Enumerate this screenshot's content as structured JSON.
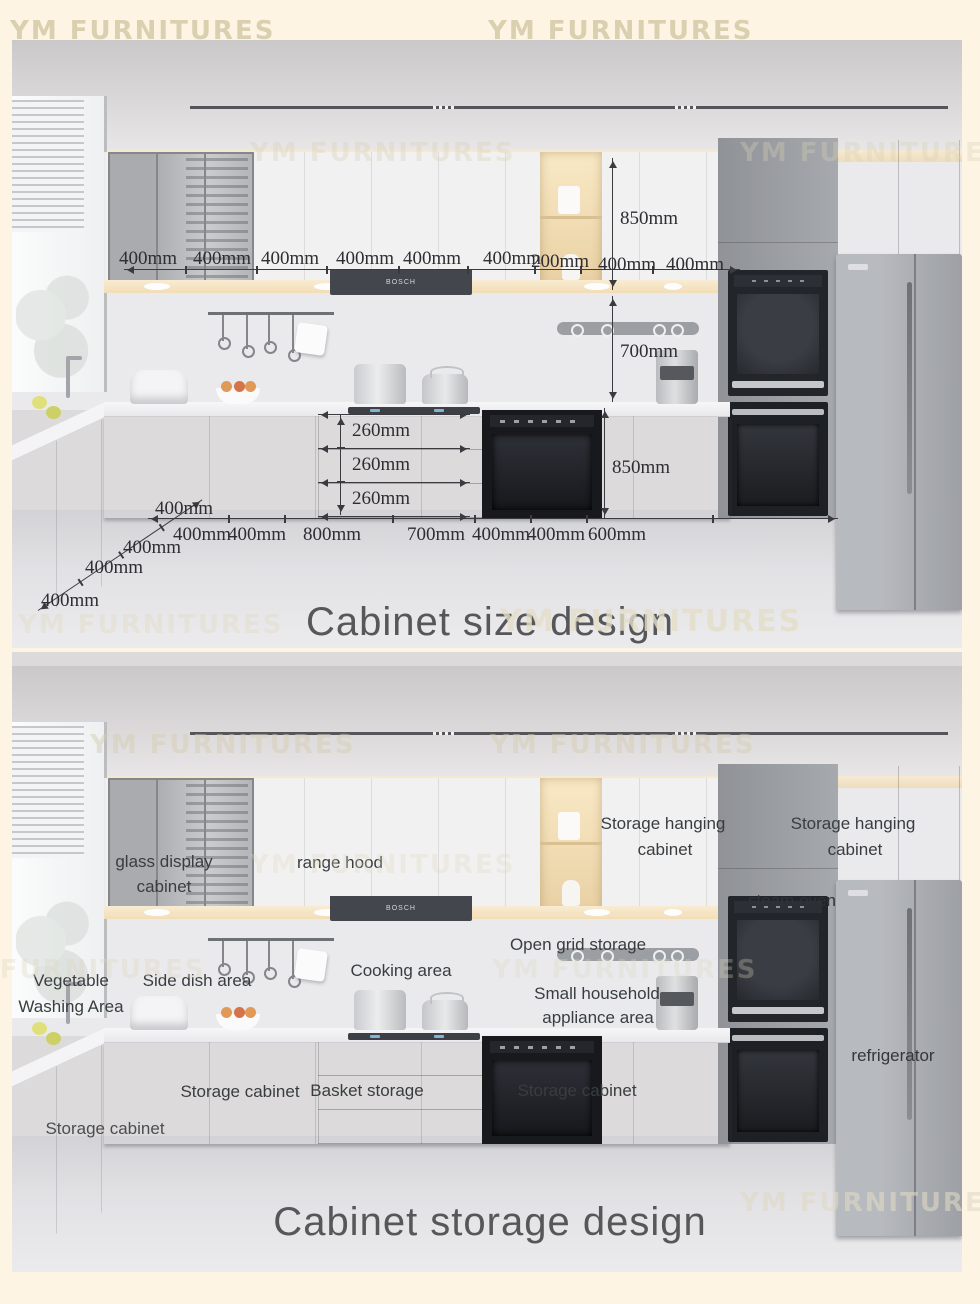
{
  "watermark": {
    "text": "YM FURNITURES"
  },
  "scene": {
    "hood_brand": "BOSCH"
  },
  "size_panel": {
    "title": "Cabinet size design",
    "top_dims": [
      "400mm",
      "400mm",
      "400mm",
      "400mm",
      "400mm",
      "400mm",
      "200mm",
      "400mm",
      "400mm"
    ],
    "height_dims": {
      "upper_cabinet": "850mm",
      "backsplash": "700mm",
      "base_cabinet": "850mm"
    },
    "drawer_dims": [
      "260mm",
      "260mm",
      "260mm"
    ],
    "bottom_dims": [
      "400mm",
      "400mm",
      "800mm",
      "700mm",
      "400mm",
      "400mm",
      "600mm"
    ],
    "left_dims": [
      "400mm",
      "400mm",
      "400mm",
      "400mm"
    ]
  },
  "storage_panel": {
    "title": "Cabinet storage design",
    "labels": {
      "glass_display_line1": "glass display",
      "glass_display_line2": "cabinet",
      "range_hood": "range hood",
      "hanging1_line1": "Storage hanging",
      "hanging1_line2": "cabinet",
      "hanging2_line1": "Storage hanging",
      "hanging2_line2": "cabinet",
      "steam_oven": "steam oven",
      "open_grid": "Open grid storage",
      "cooking": "Cooking area",
      "small_appliance_line1": "Small household",
      "small_appliance_line2": "appliance area",
      "veg_line1": "Vegetable",
      "veg_line2": "Washing Area",
      "side_dish": "Side dish area",
      "storage_cab_left": "Storage cabinet",
      "basket": "Basket storage",
      "storage_cab_right": "Storage cabinet",
      "storage_cab_far_left": "Storage cabinet",
      "refrigerator": "refrigerator"
    }
  },
  "colors": {
    "background": "#fdf4e4",
    "accent_warm_light": "#f2ddb6",
    "annotation": "#2d2d32"
  }
}
